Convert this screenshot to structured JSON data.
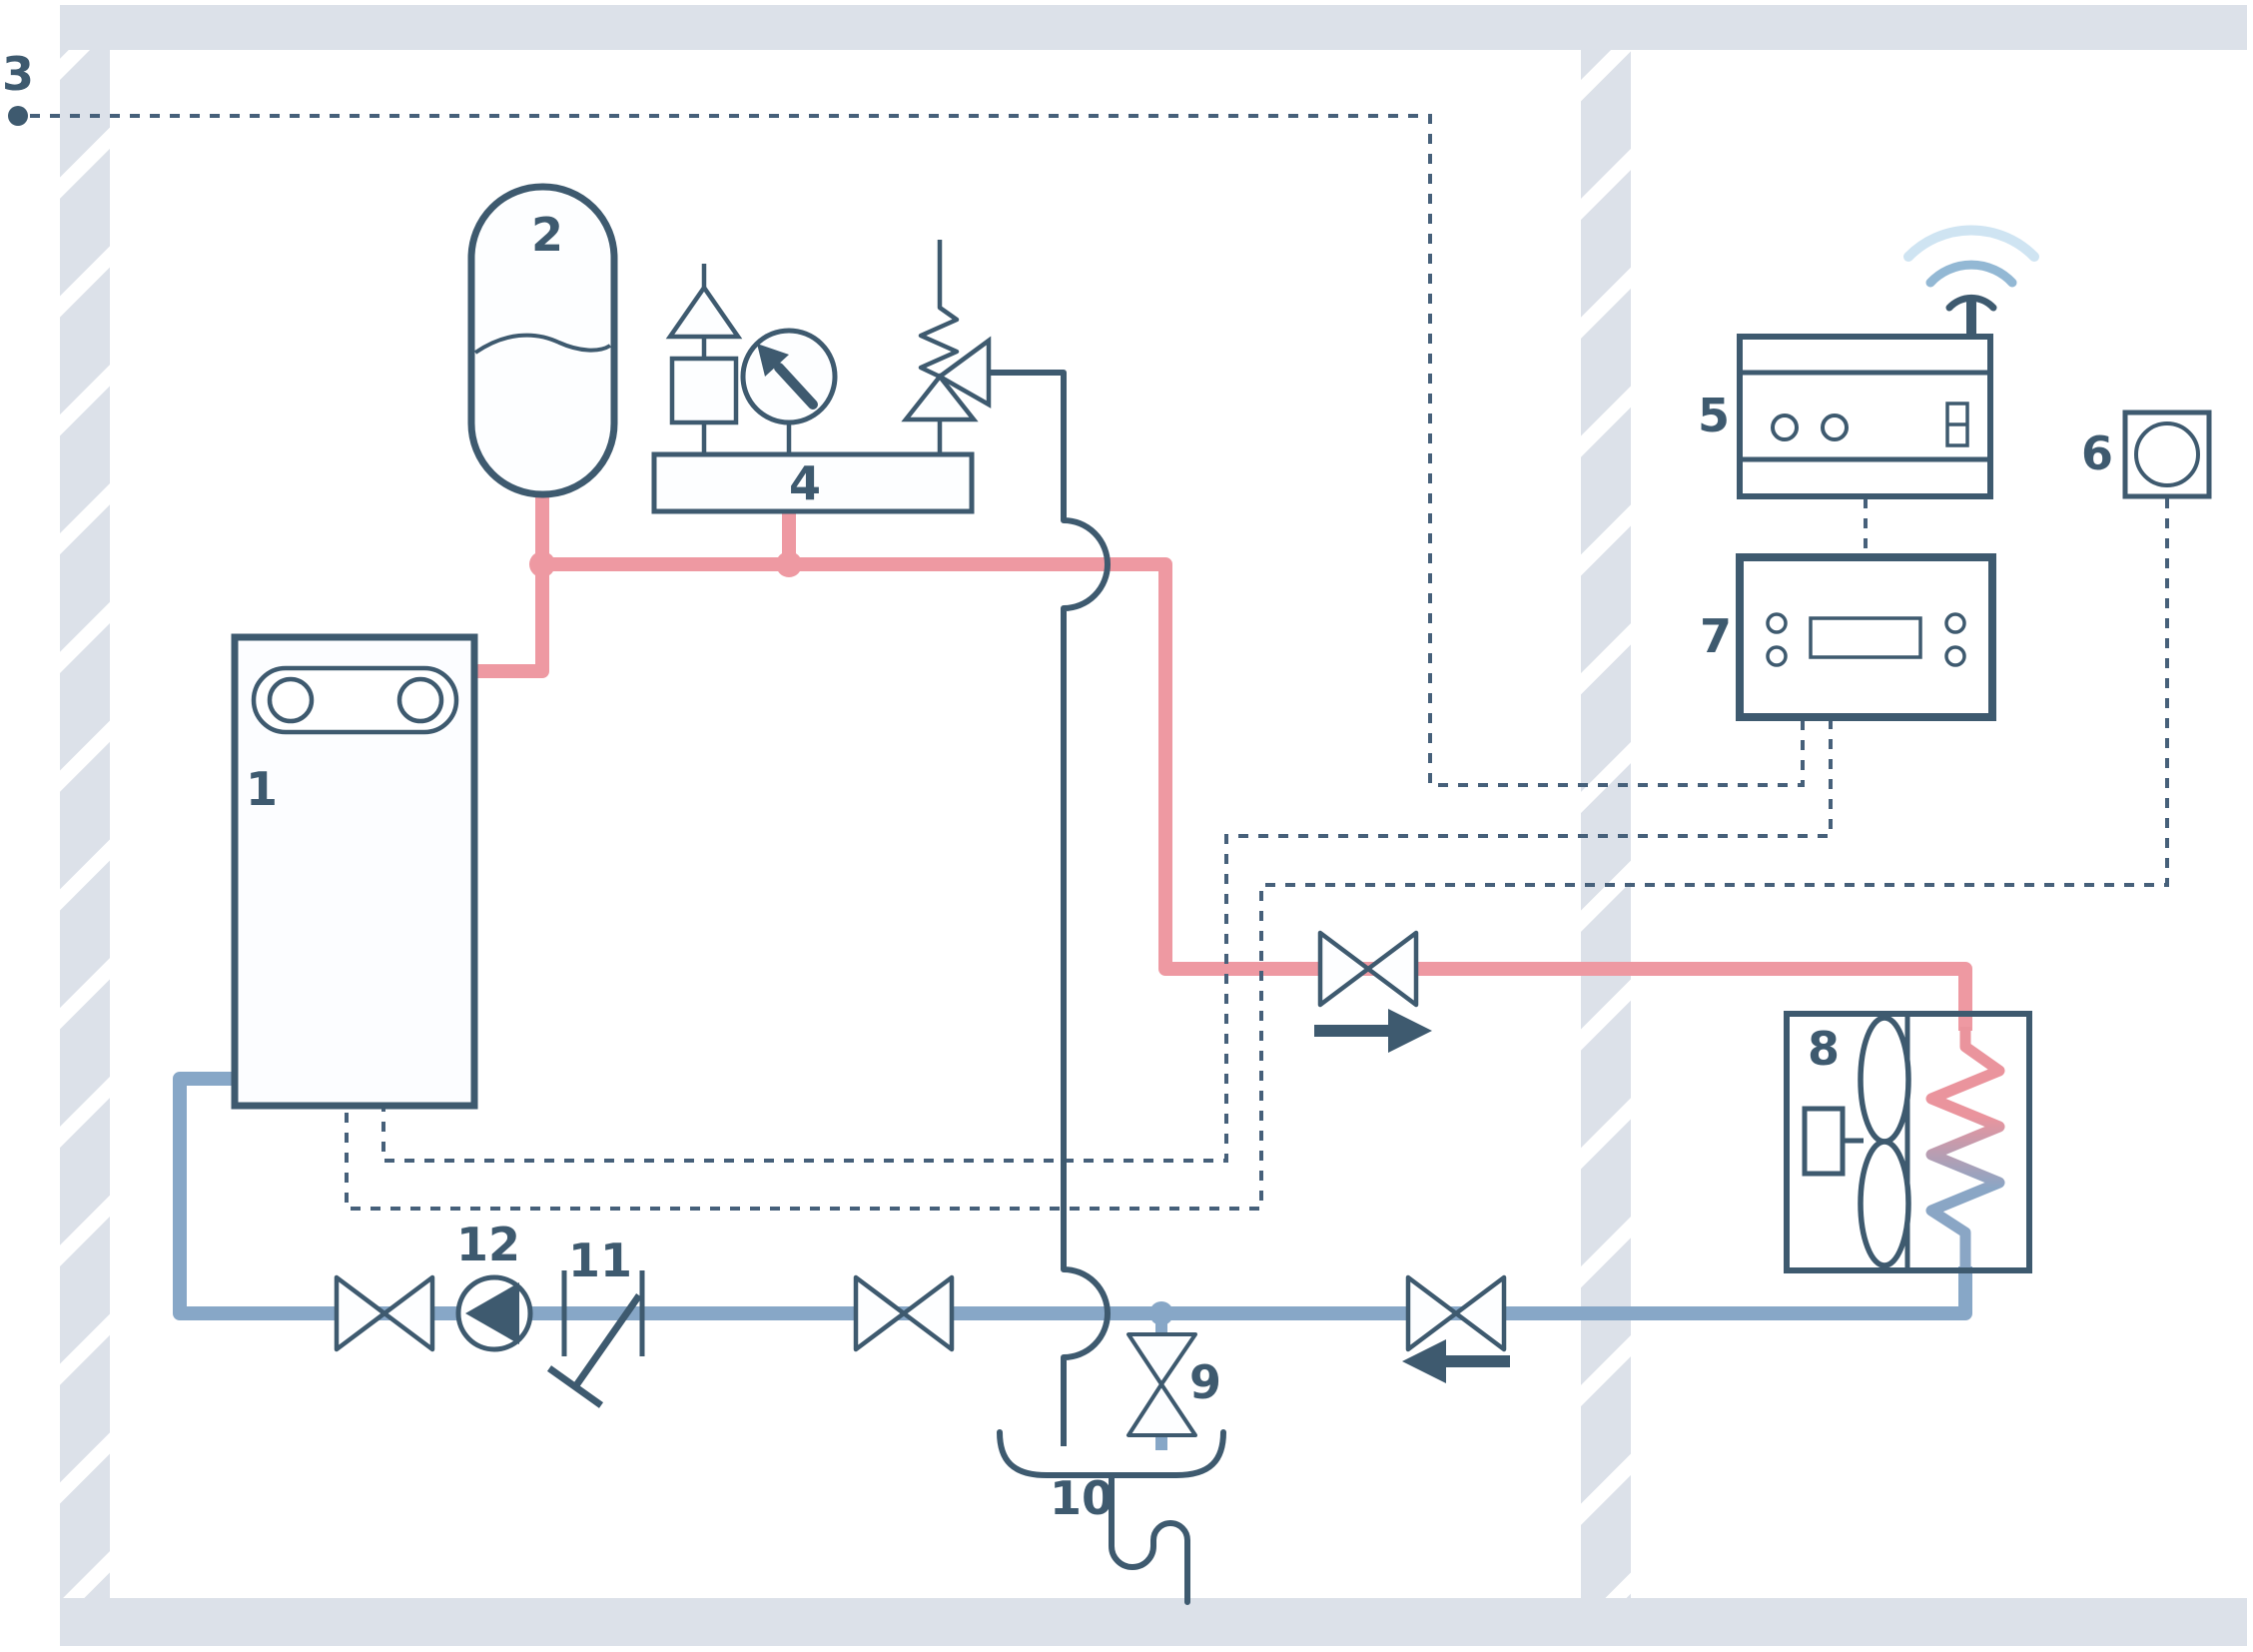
{
  "diagram": {
    "labels": {
      "n1": "1",
      "n2": "2",
      "n3": "3",
      "n4": "4",
      "n5": "5",
      "n6": "6",
      "n7": "7",
      "n8": "8",
      "n9": "9",
      "n10": "10",
      "n11": "11",
      "n12": "12"
    },
    "colors": {
      "supply_pipe_red": "#ee99a2",
      "return_pipe_blue": "#87a7c7",
      "line_dark": "#3e5a6f",
      "cable_dashed": "#46607a",
      "wall_gray": "#dce1e9",
      "wifi_small": "#3e5a6f",
      "wifi_mid": "#93b8d4",
      "wifi_large": "#cfe4f2"
    }
  }
}
